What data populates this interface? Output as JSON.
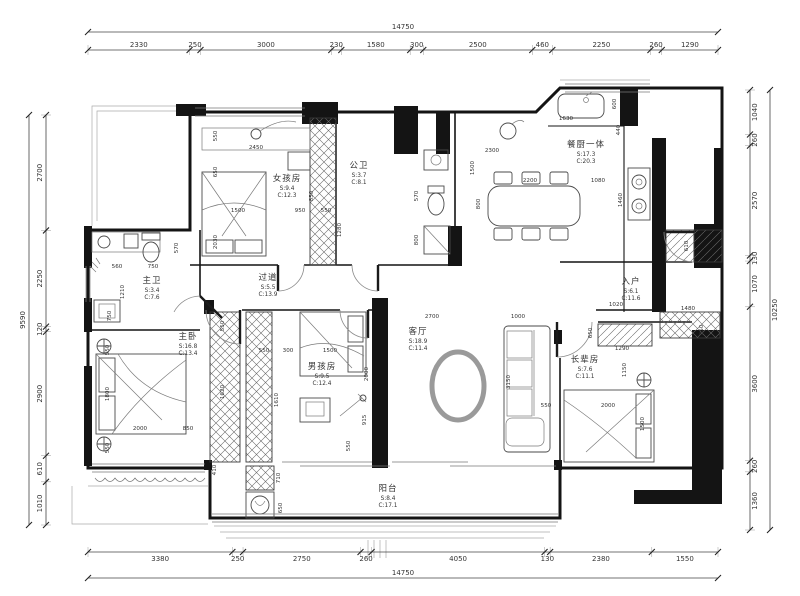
{
  "drawing": {
    "type": "apartment-floor-plan"
  },
  "colors": {
    "wall": "#141414",
    "line": "#4a4a4a",
    "dim_text": "#333333",
    "room_name": "#222222",
    "room_stat": "#4a665e",
    "background": "#ffffff"
  },
  "rooms": [
    {
      "id": "girls-room",
      "name": "女孩房",
      "area": "S:9.4",
      "ceiling": "C:12.3",
      "x": 287,
      "y": 181
    },
    {
      "id": "public-bath",
      "name": "公卫",
      "area": "S:3.7",
      "ceiling": "C:8.1",
      "x": 359,
      "y": 168
    },
    {
      "id": "dining-kitchen",
      "name": "餐厨一体",
      "area": "S:17.3",
      "ceiling": "C:20.3",
      "x": 586,
      "y": 147
    },
    {
      "id": "master-bath",
      "name": "主卫",
      "area": "S:3.4",
      "ceiling": "C:7.6",
      "x": 152,
      "y": 283
    },
    {
      "id": "hallway",
      "name": "过道",
      "area": "S:5.5",
      "ceiling": "C:13.9",
      "x": 268,
      "y": 280
    },
    {
      "id": "master-bedroom",
      "name": "主卧",
      "area": "S:16.8",
      "ceiling": "C:13.4",
      "x": 188,
      "y": 339
    },
    {
      "id": "boys-room",
      "name": "男孩房",
      "area": "S:9.5",
      "ceiling": "C:12.4",
      "x": 322,
      "y": 369
    },
    {
      "id": "living-room",
      "name": "客厅",
      "area": "S:18.9",
      "ceiling": "C:11.4",
      "x": 418,
      "y": 334
    },
    {
      "id": "entry",
      "name": "入户",
      "area": "S:6.1",
      "ceiling": "C:11.6",
      "x": 631,
      "y": 284
    },
    {
      "id": "elders-room",
      "name": "长辈房",
      "area": "S:7.6",
      "ceiling": "C:11.1",
      "x": 585,
      "y": 362
    },
    {
      "id": "balcony",
      "name": "阳台",
      "area": "S:8.4",
      "ceiling": "C:17.1",
      "x": 388,
      "y": 491
    }
  ],
  "dimensions": {
    "top": {
      "total": "14750",
      "segments": [
        "2330",
        "250",
        "3000",
        "230",
        "1580",
        "300",
        "2500",
        "460",
        "2250",
        "260",
        "1290"
      ]
    },
    "bottom": {
      "total": "14750",
      "segments": [
        "3380",
        "250",
        "2750",
        "260",
        "4050",
        "130",
        "2380",
        "1550"
      ]
    },
    "left": {
      "total": "9590",
      "segments": [
        "2700",
        "2250",
        "120",
        "2900",
        "610",
        "1010"
      ]
    },
    "right": {
      "total": "10250",
      "segments": [
        "1040",
        "260",
        "2570",
        "130",
        "1070",
        "3600",
        "260",
        "1360"
      ]
    }
  },
  "interior_dims": [
    {
      "t": "550",
      "x": 217,
      "y": 136,
      "v": true
    },
    {
      "t": "650",
      "x": 217,
      "y": 172,
      "v": true
    },
    {
      "t": "2450",
      "x": 256,
      "y": 149,
      "v": false
    },
    {
      "t": "2030",
      "x": 217,
      "y": 242,
      "v": true
    },
    {
      "t": "1500",
      "x": 238,
      "y": 212,
      "v": false
    },
    {
      "t": "950",
      "x": 300,
      "y": 212,
      "v": false
    },
    {
      "t": "550",
      "x": 326,
      "y": 212,
      "v": false
    },
    {
      "t": "1280",
      "x": 341,
      "y": 230,
      "v": true
    },
    {
      "t": "850",
      "x": 313,
      "y": 196,
      "v": true
    },
    {
      "t": "570",
      "x": 418,
      "y": 196,
      "v": true
    },
    {
      "t": "800",
      "x": 418,
      "y": 240,
      "v": true
    },
    {
      "t": "560",
      "x": 117,
      "y": 268,
      "v": false
    },
    {
      "t": "750",
      "x": 153,
      "y": 268,
      "v": false
    },
    {
      "t": "1210",
      "x": 124,
      "y": 292,
      "v": true
    },
    {
      "t": "750",
      "x": 111,
      "y": 316,
      "v": true
    },
    {
      "t": "570",
      "x": 178,
      "y": 248,
      "v": true
    },
    {
      "t": "550",
      "x": 109,
      "y": 350,
      "v": true
    },
    {
      "t": "1800",
      "x": 109,
      "y": 394,
      "v": true
    },
    {
      "t": "550",
      "x": 109,
      "y": 448,
      "v": true
    },
    {
      "t": "2000",
      "x": 140,
      "y": 430,
      "v": false
    },
    {
      "t": "850",
      "x": 188,
      "y": 430,
      "v": false
    },
    {
      "t": "1620",
      "x": 224,
      "y": 392,
      "v": true
    },
    {
      "t": "550",
      "x": 224,
      "y": 326,
      "v": true
    },
    {
      "t": "550",
      "x": 264,
      "y": 352,
      "v": false
    },
    {
      "t": "300",
      "x": 288,
      "y": 352,
      "v": false
    },
    {
      "t": "1500",
      "x": 330,
      "y": 352,
      "v": false
    },
    {
      "t": "2000",
      "x": 368,
      "y": 374,
      "v": true
    },
    {
      "t": "1610",
      "x": 278,
      "y": 400,
      "v": true
    },
    {
      "t": "915",
      "x": 366,
      "y": 420,
      "v": true
    },
    {
      "t": "550",
      "x": 350,
      "y": 446,
      "v": true
    },
    {
      "t": "2700",
      "x": 432,
      "y": 318,
      "v": false
    },
    {
      "t": "1000",
      "x": 518,
      "y": 318,
      "v": false
    },
    {
      "t": "3150",
      "x": 510,
      "y": 382,
      "v": true
    },
    {
      "t": "1020",
      "x": 616,
      "y": 306,
      "v": false
    },
    {
      "t": "650",
      "x": 592,
      "y": 333,
      "v": true
    },
    {
      "t": "1290",
      "x": 622,
      "y": 350,
      "v": false
    },
    {
      "t": "1150",
      "x": 626,
      "y": 370,
      "v": true
    },
    {
      "t": "550",
      "x": 546,
      "y": 407,
      "v": false
    },
    {
      "t": "2000",
      "x": 608,
      "y": 407,
      "v": false
    },
    {
      "t": "1500",
      "x": 644,
      "y": 424,
      "v": true
    },
    {
      "t": "1480",
      "x": 688,
      "y": 310,
      "v": false
    },
    {
      "t": "350",
      "x": 703,
      "y": 330,
      "v": true
    },
    {
      "t": "1630",
      "x": 566,
      "y": 120,
      "v": false
    },
    {
      "t": "600",
      "x": 616,
      "y": 104,
      "v": true
    },
    {
      "t": "440",
      "x": 620,
      "y": 130,
      "v": true
    },
    {
      "t": "2300",
      "x": 492,
      "y": 152,
      "v": false
    },
    {
      "t": "1500",
      "x": 474,
      "y": 168,
      "v": true
    },
    {
      "t": "2200",
      "x": 530,
      "y": 182,
      "v": false
    },
    {
      "t": "1080",
      "x": 598,
      "y": 182,
      "v": false
    },
    {
      "t": "800",
      "x": 480,
      "y": 204,
      "v": true
    },
    {
      "t": "1460",
      "x": 622,
      "y": 200,
      "v": true
    },
    {
      "t": "610",
      "x": 688,
      "y": 246,
      "v": true
    },
    {
      "t": "710",
      "x": 280,
      "y": 478,
      "v": true
    },
    {
      "t": "650",
      "x": 282,
      "y": 508,
      "v": true
    },
    {
      "t": "410",
      "x": 216,
      "y": 470,
      "v": true
    }
  ]
}
